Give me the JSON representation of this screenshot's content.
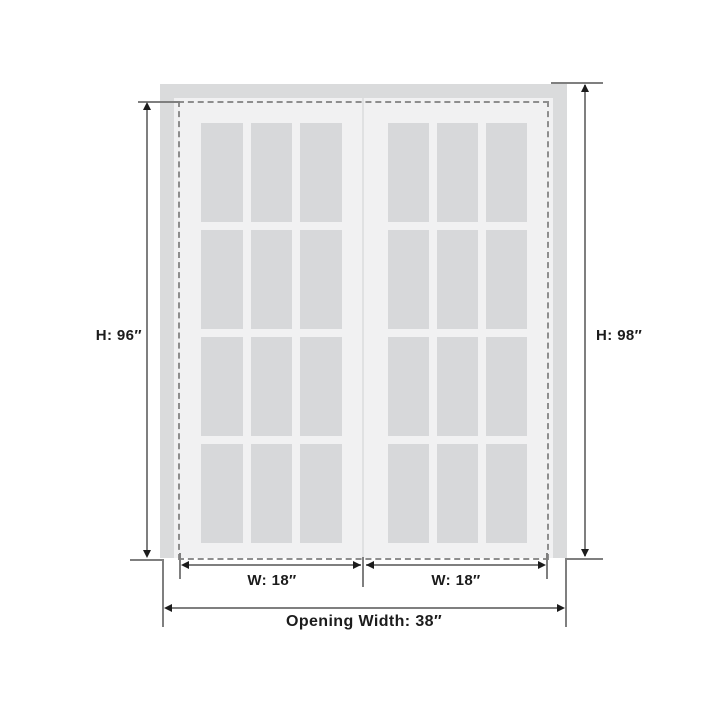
{
  "diagram": {
    "type": "door-dimension-diagram",
    "colors": {
      "background": "#ffffff",
      "frame": "#dadbdc",
      "door": "#f1f1f2",
      "glass": "#d7d8da",
      "divider": "#e0e1e2",
      "dashed": "#8e8e8e",
      "dimline": "#7f7f7f",
      "arrow": "#1c1c1c",
      "text": "#1c1c1c"
    },
    "doors": {
      "count": 2,
      "grid_rows": 4,
      "grid_cols": 3
    },
    "dimensions": {
      "door_height": "H: 96″",
      "opening_height": "H: 98″",
      "door_width_left": "W: 18″",
      "door_width_right": "W: 18″",
      "opening_width": "Opening Width: 38″"
    }
  }
}
